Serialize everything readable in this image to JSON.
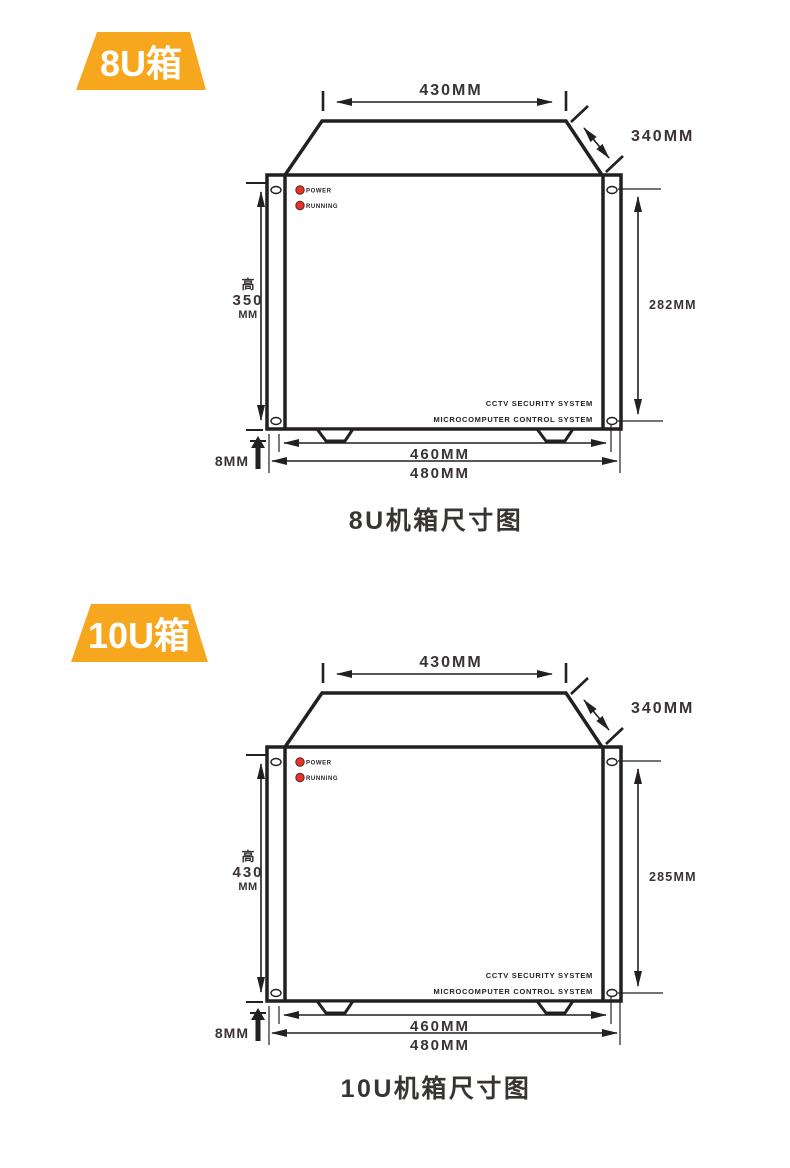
{
  "colors": {
    "accent_orange": "#f7a71e",
    "line_black": "#241f21",
    "dim_text": "#3a3234",
    "led_red": "#e73429",
    "badge_text": "#ffffff"
  },
  "diagrams": [
    {
      "badge_label": "8U箱",
      "caption": "8U机箱尺寸图",
      "dimensions": {
        "top_width": "430MM",
        "side_depth": "340MM",
        "front_height_prefix": "高",
        "front_height_value": "350",
        "front_height_unit": "MM",
        "mounting_hole_spacing": "282MM",
        "foot_height": "8MM",
        "body_width": "460MM",
        "overall_width": "480MM"
      },
      "front_panel": {
        "power_led_label": "POWER",
        "running_led_label": "RUNNING",
        "brand_line_1": "CCTV SECURITY SYSTEM",
        "brand_line_2": "MICROCOMPUTER CONTROL SYSTEM"
      }
    },
    {
      "badge_label": "10U箱",
      "caption": "10U机箱尺寸图",
      "dimensions": {
        "top_width": "430MM",
        "side_depth": "340MM",
        "front_height_prefix": "高",
        "front_height_value": "430",
        "front_height_unit": "MM",
        "mounting_hole_spacing": "285MM",
        "foot_height": "8MM",
        "body_width": "460MM",
        "overall_width": "480MM"
      },
      "front_panel": {
        "power_led_label": "POWER",
        "running_led_label": "RUNNING",
        "brand_line_1": "CCTV SECURITY SYSTEM",
        "brand_line_2": "MICROCOMPUTER CONTROL SYSTEM"
      }
    }
  ]
}
